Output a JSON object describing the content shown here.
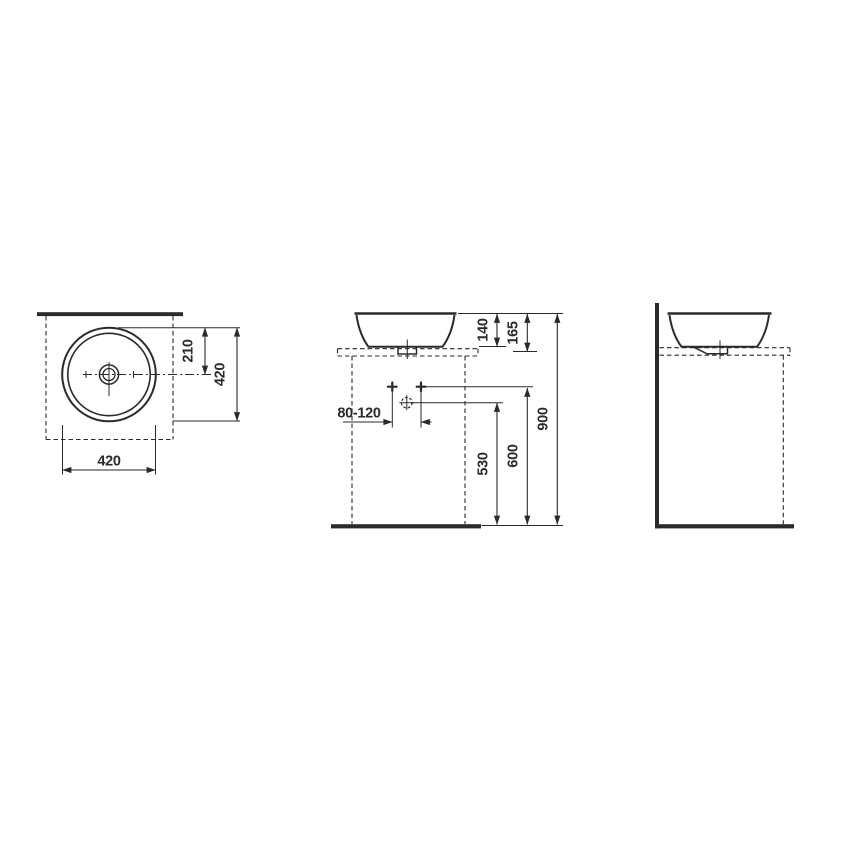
{
  "drawing": {
    "line_color": "#2a2a2a",
    "background_color": "#ffffff"
  },
  "views": {
    "top": {
      "dim_center_from_front": "210",
      "dim_overall_depth": "420",
      "dim_overall_width": "420"
    },
    "front": {
      "dim_basin_height": "140",
      "dim_basin_total_height": "165",
      "dim_rim_height": "900",
      "dim_supply_height": "600",
      "dim_drain_height": "530",
      "dim_hole_spacing": "80-120"
    }
  }
}
